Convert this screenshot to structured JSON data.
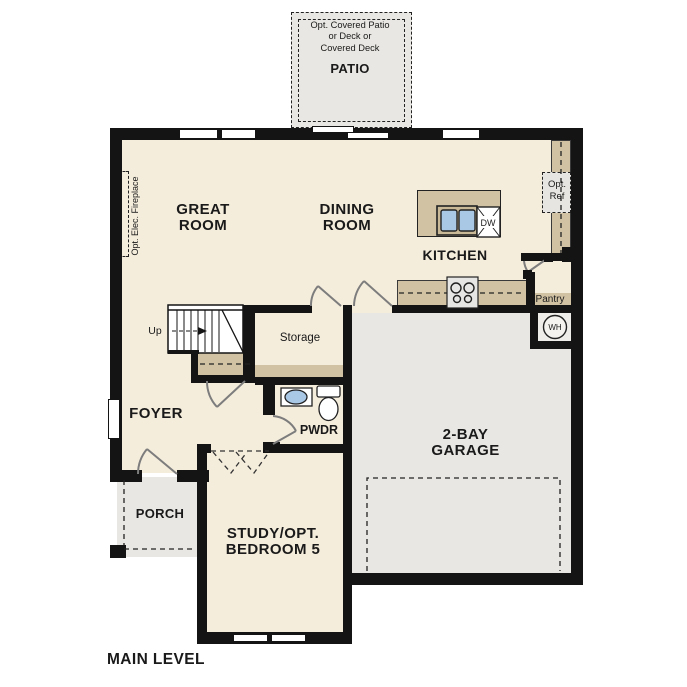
{
  "title": "MAIN LEVEL",
  "labels": {
    "main_level": "MAIN LEVEL",
    "great_room": "GREAT\nROOM",
    "dining_room": "DINING\nROOM",
    "kitchen": "KITCHEN",
    "garage": "2-BAY\nGARAGE",
    "study": "STUDY/OPT.\nBEDROOM 5",
    "foyer": "FOYER",
    "porch": "PORCH",
    "powder": "PWDR",
    "storage": "Storage",
    "pantry": "Pantry",
    "patio": "PATIO",
    "patio_note": "Opt. Covered Patio\nor Deck or\nCovered Deck",
    "fireplace": "Opt. Elec. Fireplace",
    "opt_ref": "Opt.\nRef",
    "up": "Up",
    "dw": "DW",
    "wh": "WH"
  },
  "colors": {
    "wall": "#141414",
    "floor": "#f5eddc",
    "hard_surface": "#e8e7e3",
    "counter": "#d1c2a4",
    "sink_fixture": "#a9c8e6"
  }
}
